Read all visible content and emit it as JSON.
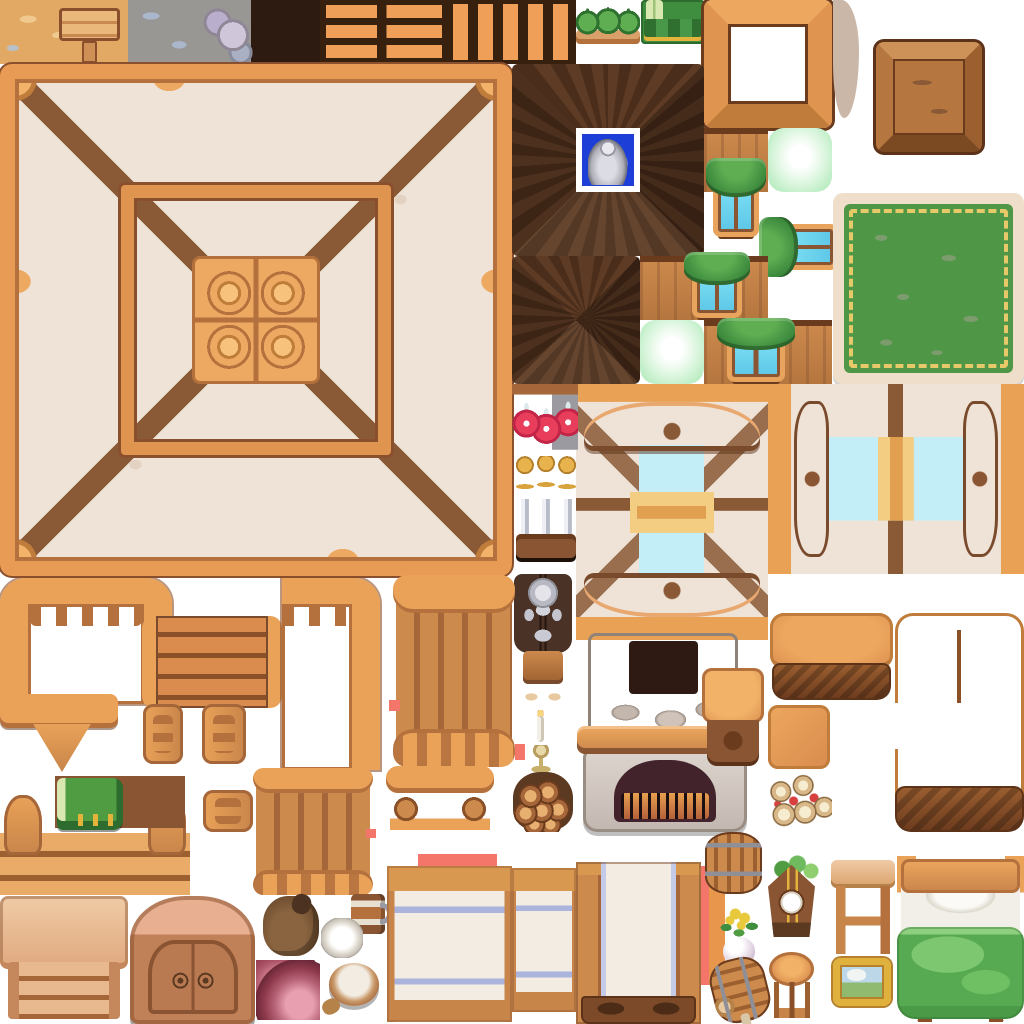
{
  "sheet": {
    "title": "wooden-interior-tileset",
    "width": 1024,
    "height": 1024,
    "background": "#ffffff",
    "tile_unit": 64
  },
  "palette": {
    "sheet-bg": "#ffffff",
    "wood-light": "#f2b368",
    "wood-mid": "#d98c4e",
    "wood-deep": "#a5663a",
    "wood-dark": "#7a4a2c",
    "beam": "#8a5a36",
    "outline": "#5c3318",
    "cream": "#efe3d7",
    "plaster": "#e5d5c8",
    "roof-dark": "#5e3b24",
    "roof-darker": "#4a2d1a",
    "green-curtain": "#3f8d3f",
    "green-glow": "#bfeec6",
    "rug-green": "#4f9747",
    "rug-border": "#efdfca",
    "tassel": "#e8c96a",
    "glass": "#c3eef8",
    "gold": "#f2cd82",
    "stone": "#cfc3ba",
    "stone-dark": "#9a8d84",
    "fire": "#42232c",
    "ember": "#e8a050",
    "blanket": "#57aa52",
    "potion": "#e83e5c",
    "silver": "#c9ccd6",
    "marker": "#f4766b",
    "sand": "#e2a964",
    "stonefloor": "#999793",
    "darktile": "#2d1a11",
    "shelfbg": "#38200f",
    "skylight-blue": "#1d3fd8"
  },
  "tiles": [
    {
      "name": "ground-sand-sign",
      "kind": "sand",
      "x": 0,
      "y": 0,
      "w": 128,
      "h": 64
    },
    {
      "name": "ground-stone",
      "kind": "stone",
      "x": 128,
      "y": 0,
      "w": 128,
      "h": 64
    },
    {
      "name": "dark-square-tile",
      "kind": "flat",
      "color": "#2d1a11",
      "x": 256,
      "y": 0,
      "w": 64,
      "h": 64
    },
    {
      "name": "wall-shelf-horizontal-planks",
      "kind": "shelfH",
      "x": 320,
      "y": 0,
      "w": 128,
      "h": 64
    },
    {
      "name": "wall-shelf-vertical-planks",
      "kind": "shelfV",
      "x": 448,
      "y": 0,
      "w": 128,
      "h": 64
    },
    {
      "name": "shelf-green-sacks",
      "kind": "sacks",
      "x": 576,
      "y": 2,
      "w": 64,
      "h": 42
    },
    {
      "name": "shelf-green-bundles",
      "kind": "bundles",
      "x": 641,
      "y": 0,
      "w": 64,
      "h": 44
    },
    {
      "name": "wood-frame-open",
      "kind": "bigframe",
      "x": 704,
      "y": 0,
      "w": 128,
      "h": 128
    },
    {
      "name": "plaster-scrap",
      "kind": "blob",
      "x": 833,
      "y": 0,
      "w": 26,
      "h": 118
    },
    {
      "name": "crate-top",
      "kind": "crate",
      "x": 876,
      "y": 42,
      "w": 106,
      "h": 110
    },
    {
      "name": "ceiling-room",
      "kind": "ceiling",
      "x": 0,
      "y": 64,
      "w": 512,
      "h": 512
    },
    {
      "name": "roof-peak-skylight",
      "kind": "roofpeak",
      "x": 512,
      "y": 64,
      "w": 192,
      "h": 192
    },
    {
      "name": "skylight-white",
      "kind": "flat",
      "color": "#ffffff",
      "x": 576,
      "y": 128,
      "w": 64,
      "h": 64
    },
    {
      "name": "skylight-blue",
      "kind": "flat",
      "color": "#1d3fd8",
      "x": 582,
      "y": 134,
      "w": 52,
      "h": 52
    },
    {
      "name": "silver-stein",
      "kind": "stein",
      "x": 588,
      "y": 138,
      "w": 40,
      "h": 47
    },
    {
      "name": "roof-peak-2",
      "kind": "roofpeak2",
      "x": 512,
      "y": 256,
      "w": 128,
      "h": 128
    },
    {
      "name": "roof-wood-tile-a",
      "kind": "woodtile",
      "x": 704,
      "y": 128,
      "w": 64,
      "h": 64
    },
    {
      "name": "glow-tile-a",
      "kind": "glow",
      "x": 768,
      "y": 128,
      "w": 64,
      "h": 64
    },
    {
      "name": "dormer-window-1",
      "kind": "dormer",
      "x": 704,
      "y": 158,
      "w": 64,
      "h": 82
    },
    {
      "name": "dormer-window-2",
      "kind": "dormer",
      "rot": -90,
      "x": 768,
      "y": 206,
      "w": 64,
      "h": 82
    },
    {
      "name": "roof-wood-tile-b",
      "kind": "woodtile",
      "x": 640,
      "y": 256,
      "w": 128,
      "h": 64
    },
    {
      "name": "dormer-window-3",
      "kind": "dormer",
      "x": 682,
      "y": 252,
      "w": 70,
      "h": 68
    },
    {
      "name": "glow-tile-b",
      "kind": "glow",
      "x": 640,
      "y": 320,
      "w": 64,
      "h": 64
    },
    {
      "name": "roof-wood-tile-c",
      "kind": "woodtile",
      "x": 704,
      "y": 320,
      "w": 128,
      "h": 64
    },
    {
      "name": "dormer-window-4",
      "kind": "dormer",
      "x": 714,
      "y": 318,
      "w": 84,
      "h": 66
    },
    {
      "name": "green-rug",
      "kind": "rug",
      "x": 833,
      "y": 193,
      "w": 191,
      "h": 191
    },
    {
      "name": "window-top-view",
      "kind": "windowbig",
      "x": 576,
      "y": 384,
      "w": 192,
      "h": 256
    },
    {
      "name": "window-side-view",
      "kind": "windowside",
      "x": 768,
      "y": 384,
      "w": 256,
      "h": 190
    },
    {
      "name": "potion-rack",
      "kind": "potions",
      "x": 512,
      "y": 384,
      "w": 66,
      "h": 66
    },
    {
      "name": "sword-rack",
      "kind": "swords",
      "x": 513,
      "y": 456,
      "w": 66,
      "h": 102
    },
    {
      "name": "knight-armor-statue",
      "kind": "knight",
      "x": 514,
      "y": 574,
      "w": 58,
      "h": 128
    },
    {
      "name": "candle-stand",
      "kind": "candle",
      "x": 527,
      "y": 710,
      "w": 28,
      "h": 62
    },
    {
      "name": "firewood-pile",
      "kind": "logs",
      "x": 512,
      "y": 770,
      "w": 62,
      "h": 62
    },
    {
      "name": "fireplace-chimney",
      "kind": "chimney",
      "x": 588,
      "y": 633,
      "w": 150,
      "h": 102
    },
    {
      "name": "fireplace-hearth",
      "kind": "hearth",
      "x": 583,
      "y": 748,
      "w": 164,
      "h": 84
    },
    {
      "name": "fireplace-mantel",
      "kind": "mantel",
      "x": 577,
      "y": 726,
      "w": 178,
      "h": 28
    },
    {
      "name": "side-table",
      "kind": "sidetable",
      "x": 702,
      "y": 668,
      "w": 62,
      "h": 98
    },
    {
      "name": "couch-seat",
      "kind": "couch",
      "x": 770,
      "y": 613,
      "w": 123,
      "h": 87
    },
    {
      "name": "counter-g-shape",
      "kind": "counterg",
      "x": 895,
      "y": 613,
      "w": 129,
      "h": 219
    },
    {
      "name": "couch-cushion",
      "kind": "couchsq",
      "x": 768,
      "y": 705,
      "w": 62,
      "h": 64
    },
    {
      "name": "scroll-pile",
      "kind": "scrolls",
      "x": 768,
      "y": 770,
      "w": 64,
      "h": 62
    },
    {
      "name": "railing-corner-left",
      "kind": "railur",
      "x": 0,
      "y": 578,
      "w": 172,
      "h": 126
    },
    {
      "name": "railing-ledge",
      "kind": "railbar",
      "x": 0,
      "y": 694,
      "w": 118,
      "h": 34
    },
    {
      "name": "railing-finial",
      "kind": "finial",
      "x": 32,
      "y": 724,
      "w": 60,
      "h": 48
    },
    {
      "name": "stair-steps-top",
      "kind": "planksH",
      "x": 142,
      "y": 616,
      "w": 140,
      "h": 92
    },
    {
      "name": "railing-corner-right",
      "kind": "railur2",
      "x": 282,
      "y": 578,
      "w": 98,
      "h": 192
    },
    {
      "name": "railing-column",
      "kind": "railcol",
      "x": 396,
      "y": 575,
      "w": 116,
      "h": 192
    },
    {
      "name": "railing-post-a",
      "kind": "railpost",
      "x": 143,
      "y": 704,
      "w": 40,
      "h": 60
    },
    {
      "name": "railing-post-b",
      "kind": "railpost",
      "x": 202,
      "y": 704,
      "w": 44,
      "h": 60
    },
    {
      "name": "railing-knob",
      "kind": "railpost",
      "x": 203,
      "y": 790,
      "w": 50,
      "h": 42
    },
    {
      "name": "stairs-front",
      "kind": "stairsfront",
      "x": 0,
      "y": 795,
      "w": 190,
      "h": 100
    },
    {
      "name": "book-shelf-strip",
      "kind": "flat",
      "color": "#8a5532",
      "x": 55,
      "y": 776,
      "w": 130,
      "h": 52
    },
    {
      "name": "green-book",
      "kind": "book",
      "x": 57,
      "y": 778,
      "w": 66,
      "h": 52
    },
    {
      "name": "railing-column-2",
      "kind": "railcol",
      "x": 256,
      "y": 768,
      "w": 114,
      "h": 127
    },
    {
      "name": "bench-small",
      "kind": "bench",
      "x": 386,
      "y": 766,
      "w": 108,
      "h": 64
    },
    {
      "name": "marker-dot-a",
      "kind": "flat",
      "color": "#f4766b",
      "x": 389,
      "y": 700,
      "w": 11,
      "h": 11
    },
    {
      "name": "marker-dot-b",
      "kind": "flat",
      "color": "#f4766b",
      "x": 515,
      "y": 744,
      "w": 10,
      "h": 16
    },
    {
      "name": "marker-dot-c",
      "kind": "flat",
      "color": "#f4766b",
      "x": 366,
      "y": 829,
      "w": 10,
      "h": 9
    },
    {
      "name": "marker-strip-top",
      "kind": "flat",
      "color": "#f4766b",
      "x": 418,
      "y": 854,
      "w": 79,
      "h": 12
    },
    {
      "name": "marker-strip-side",
      "kind": "flat",
      "color": "#f4766b",
      "x": 700,
      "y": 866,
      "w": 9,
      "h": 119
    },
    {
      "name": "orange-strip",
      "kind": "flat",
      "color": "#e8964c",
      "x": 709,
      "y": 884,
      "w": 16,
      "h": 101
    },
    {
      "name": "desk-front",
      "kind": "desk",
      "x": 0,
      "y": 896,
      "w": 128,
      "h": 126
    },
    {
      "name": "wardrobe-arched",
      "kind": "wardrobe",
      "x": 130,
      "y": 896,
      "w": 125,
      "h": 128
    },
    {
      "name": "sack-brown",
      "kind": "sack",
      "x": 263,
      "y": 896,
      "w": 56,
      "h": 60
    },
    {
      "name": "mug",
      "kind": "mug",
      "x": 351,
      "y": 894,
      "w": 34,
      "h": 40
    },
    {
      "name": "plate",
      "kind": "plate",
      "x": 321,
      "y": 918,
      "w": 42,
      "h": 40
    },
    {
      "name": "ham",
      "kind": "ham",
      "x": 256,
      "y": 960,
      "w": 64,
      "h": 60
    },
    {
      "name": "flour-bowl",
      "kind": "bowl",
      "x": 329,
      "y": 960,
      "w": 50,
      "h": 56
    },
    {
      "name": "table-cloth-long",
      "kind": "clothtable",
      "x": 387,
      "y": 866,
      "w": 125,
      "h": 156
    },
    {
      "name": "table-cloth-edge",
      "kind": "clothtable",
      "x": 512,
      "y": 868,
      "w": 64,
      "h": 144
    },
    {
      "name": "table-cloth-front",
      "kind": "clothtable2",
      "x": 576,
      "y": 862,
      "w": 125,
      "h": 162
    },
    {
      "name": "barrel-upright",
      "kind": "barrel",
      "x": 705,
      "y": 832,
      "w": 57,
      "h": 62
    },
    {
      "name": "flower-vase",
      "kind": "flower",
      "x": 716,
      "y": 905,
      "w": 46,
      "h": 60
    },
    {
      "name": "barrel-tipped",
      "kind": "barreltip",
      "x": 712,
      "y": 958,
      "w": 56,
      "h": 64
    },
    {
      "name": "cuckoo-clock",
      "kind": "clock",
      "x": 768,
      "y": 855,
      "w": 47,
      "h": 82
    },
    {
      "name": "stool-round",
      "kind": "stoolround",
      "x": 769,
      "y": 952,
      "w": 45,
      "h": 66
    },
    {
      "name": "desk-side-view",
      "kind": "deskside",
      "x": 831,
      "y": 860,
      "w": 64,
      "h": 94
    },
    {
      "name": "painting-gold-frame",
      "kind": "painting",
      "x": 833,
      "y": 958,
      "w": 58,
      "h": 48
    },
    {
      "name": "bed-green",
      "kind": "bed",
      "x": 897,
      "y": 856,
      "w": 127,
      "h": 166
    }
  ]
}
